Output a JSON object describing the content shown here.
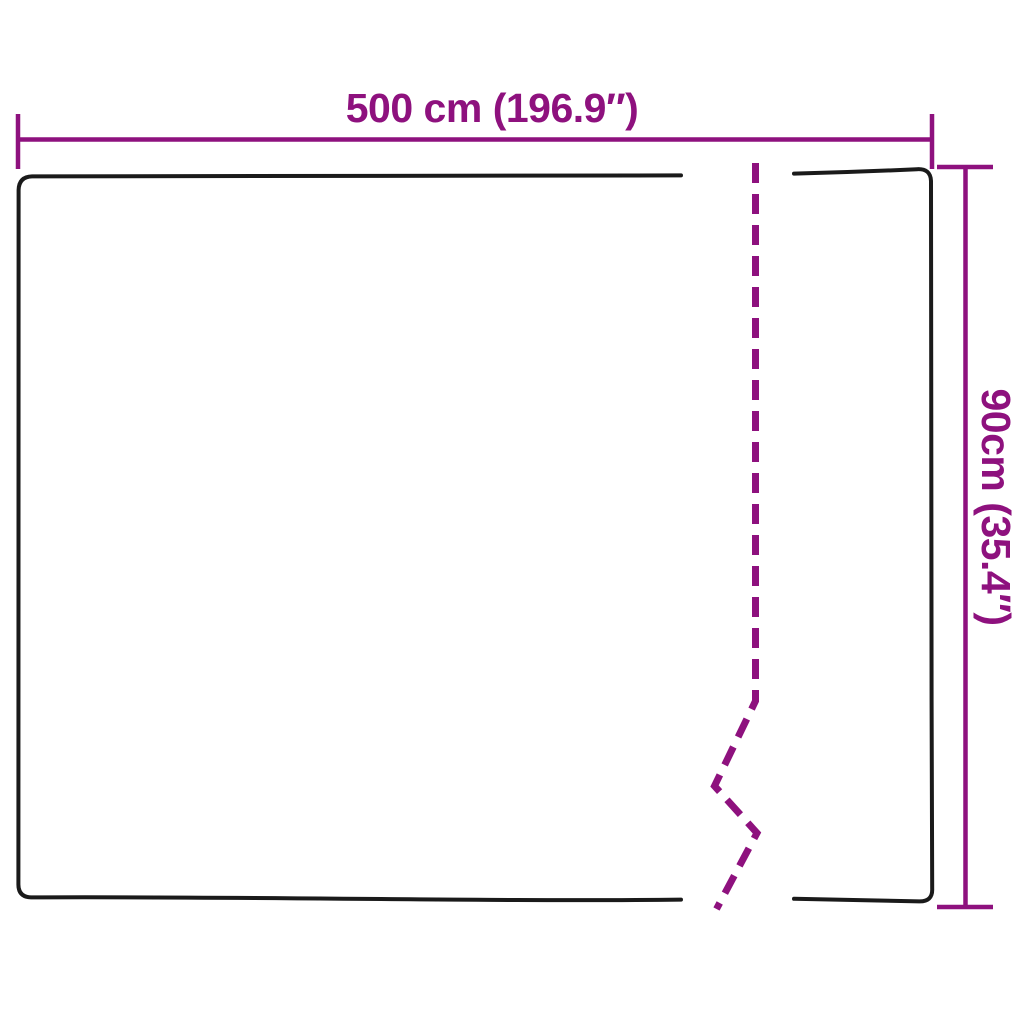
{
  "colors": {
    "page_bg": "#ffffff",
    "dimension": "#8E117E",
    "outline": "#1A1A1A"
  },
  "diagram": {
    "type": "product-dimension-diagram",
    "width_label": "500 cm (196.9″)",
    "height_label": "90cm (35.4″)",
    "dimensions": {
      "width_cm": "500",
      "width_in": "196.9",
      "height_cm": "90",
      "height_in": "35.4"
    }
  }
}
